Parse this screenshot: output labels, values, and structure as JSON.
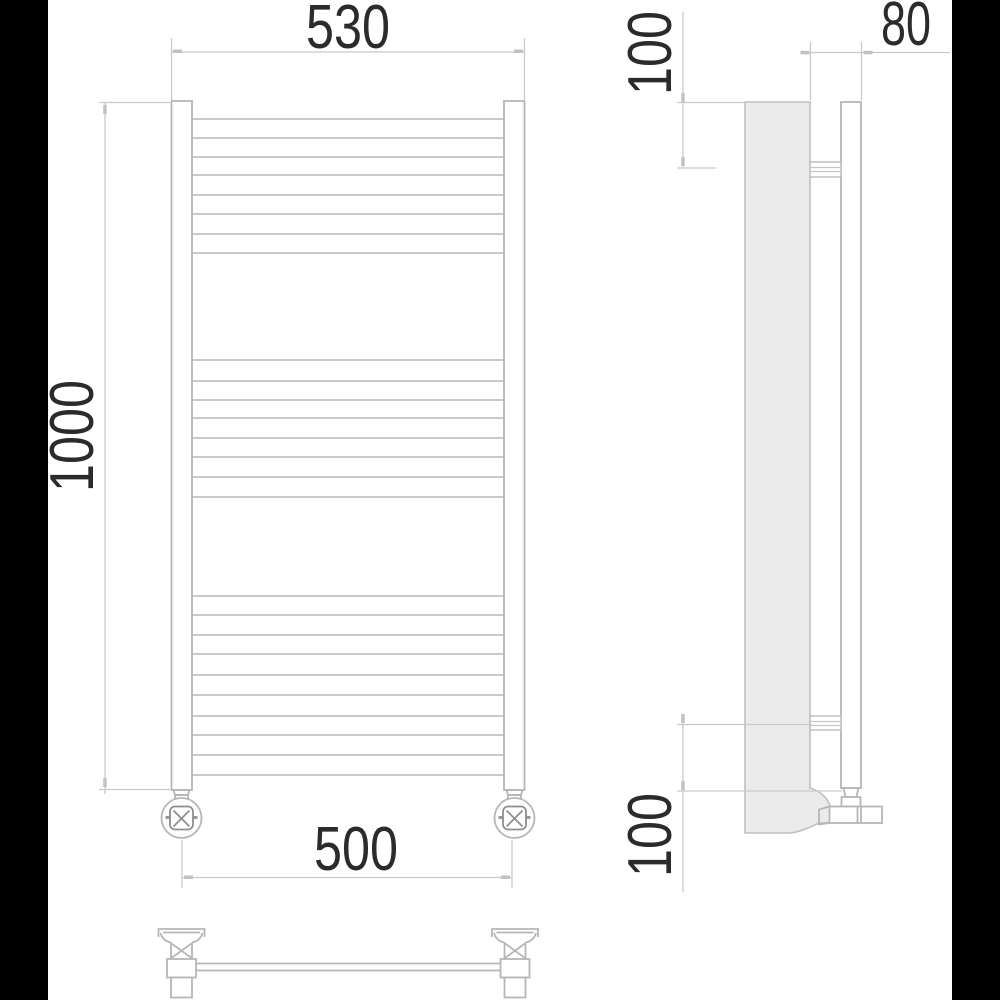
{
  "colors": {
    "background": "#ffffff",
    "letterbox": "#000000",
    "line": "#b6b6ba",
    "dimension_line": "#c9c9cd",
    "panel_fill": "#ebebeb",
    "text": "#2b2b2b"
  },
  "dimensions": {
    "width": "530",
    "height": "1000",
    "connection_spacing": "500",
    "depth": "80",
    "top_bracket_offset": "100",
    "bottom_bracket_offset": "100"
  }
}
